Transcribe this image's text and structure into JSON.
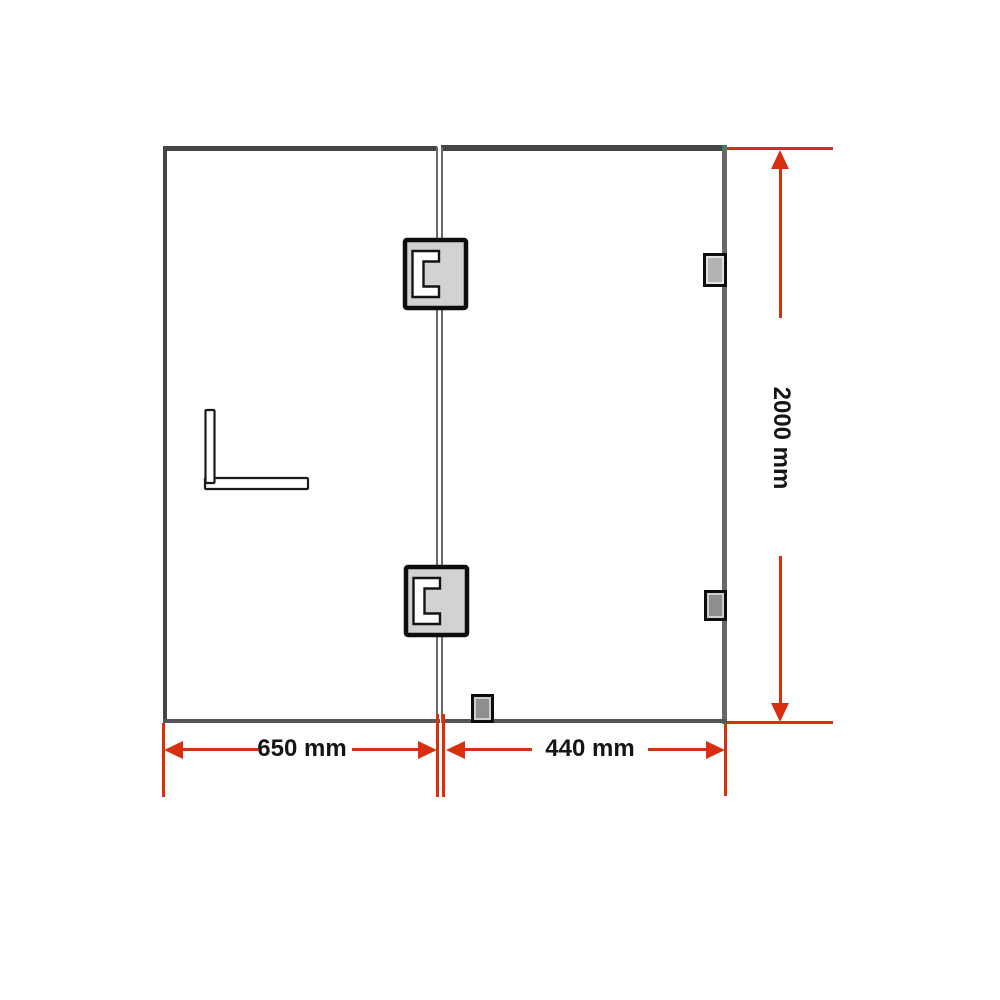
{
  "diagram": {
    "type": "frameless shower screen dimension drawing",
    "dimensions": {
      "left_panel_width": {
        "label": "650 mm",
        "value": 650,
        "unit": "mm"
      },
      "door_panel_width": {
        "label": "440 mm",
        "value": 440,
        "unit": "mm"
      },
      "overall_height": {
        "label": "2000 mm",
        "value": 2000,
        "unit": "mm"
      }
    },
    "colors": {
      "dimension_red": "#d8300e",
      "frame_dark": "#454545",
      "frame_mid": "#686868",
      "hinge_fill": "#d2d2d2",
      "bracket_fill_light": "#b2b2b2",
      "bracket_fill_dark": "#8e8e8e",
      "label_text": "#151515",
      "background": "#ffffff"
    },
    "components": [
      "fixed-glass-panel",
      "hinged-door-panel",
      "glass-to-glass-hinge-top",
      "glass-to-glass-hinge-bottom",
      "wall-bracket-top",
      "wall-bracket-bottom",
      "floor-bracket",
      "l-shaped-door-handle"
    ]
  }
}
